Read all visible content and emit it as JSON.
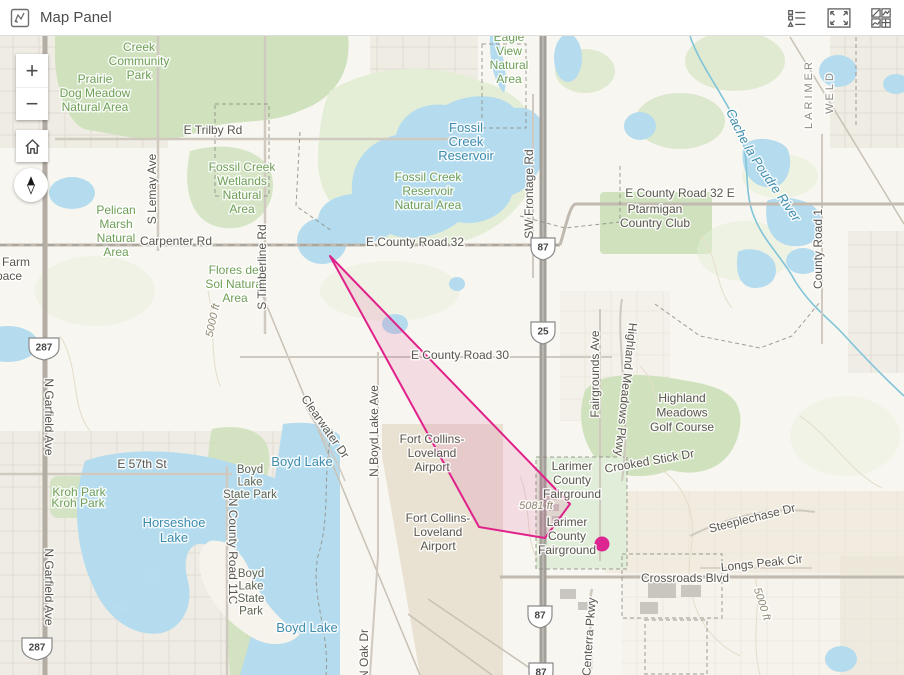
{
  "header": {
    "title": "Map Panel",
    "icons": [
      {
        "name": "map-panel-icon"
      },
      {
        "name": "legend-icon"
      },
      {
        "name": "expand-icon"
      },
      {
        "name": "basemap-gallery-icon"
      }
    ]
  },
  "controls": {
    "zoom_in_label": "+",
    "zoom_out_label": "−",
    "home": "home",
    "compass": "north"
  },
  "map": {
    "river_label": "Cache la Poudre River",
    "colors": {
      "highlight_pink": "#e0218a",
      "dot_magenta": "#dc2590",
      "water_blue": "#b5dcee",
      "park_green": "#cfe2bd",
      "label_green": "#6f9f58",
      "label_water": "#3f8cad",
      "label_road": "#5a564f",
      "highway_gray": "#a39f99"
    },
    "graphics": {
      "polygon": {
        "points": [
          [
            330,
            220
          ],
          [
            570,
            468
          ],
          [
            545,
            502
          ],
          [
            479,
            491
          ]
        ],
        "stroke": "#e0218a",
        "fill_opacity": 0.12
      },
      "dot": {
        "x": 602,
        "y": 508,
        "r": 7.5,
        "color": "#dc2590"
      }
    },
    "shields": [
      {
        "t": "87",
        "x": 543,
        "y": 211
      },
      {
        "t": "25",
        "x": 543,
        "y": 295
      },
      {
        "t": "87",
        "x": 540,
        "y": 579
      },
      {
        "t": "87",
        "x": 541,
        "y": 636
      },
      {
        "t": "287",
        "x": 44,
        "y": 311,
        "w": 15
      },
      {
        "t": "287",
        "x": 37,
        "y": 611,
        "w": 15
      }
    ],
    "labels": [
      {
        "lines": [
          "Creek",
          "Community",
          "Park"
        ],
        "x": 139,
        "y": 15,
        "cls": "park"
      },
      {
        "lines": [
          "Prairie",
          "Dog Meadow",
          "Natural Area"
        ],
        "x": 95,
        "y": 47,
        "cls": "park"
      },
      {
        "t": "E Trilby Rd",
        "x": 213,
        "y": 98,
        "cls": "road"
      },
      {
        "lines": [
          "Fossil Creek",
          "Wetlands",
          "Natural",
          "Area"
        ],
        "x": 242,
        "y": 135,
        "cls": "park"
      },
      {
        "lines": [
          "Fossil Creek",
          "Reservoir",
          "Natural Area"
        ],
        "x": 428,
        "y": 145,
        "cls": "park"
      },
      {
        "lines": [
          "Eagle",
          "View",
          "Natural",
          "Area"
        ],
        "x": 509,
        "y": 5,
        "cls": "park"
      },
      {
        "lines": [
          "Pelican",
          "Marsh",
          "Natural",
          "Area"
        ],
        "x": 116,
        "y": 178,
        "cls": "park"
      },
      {
        "lines": [
          "Flores del",
          "Sol Natural",
          "Area"
        ],
        "x": 235,
        "y": 238,
        "cls": "park"
      },
      {
        "t": "Kroh Park",
        "x": 79,
        "y": 460,
        "cls": "park"
      },
      {
        "t": "Kroh Park",
        "x": 78,
        "y": 471,
        "cls": "park",
        "color": "#55863f"
      },
      {
        "lines": [
          "Fossil",
          "Creek",
          "Reservoir"
        ],
        "x": 466,
        "y": 96,
        "cls": "water"
      },
      {
        "lines": [
          "Horseshoe",
          "Lake"
        ],
        "x": 174,
        "y": 491,
        "cls": "water",
        "lh": 15
      },
      {
        "t": "Boyd Lake",
        "x": 302,
        "y": 430,
        "cls": "water"
      },
      {
        "t": "Boyd Lake",
        "x": 307,
        "y": 596,
        "cls": "water"
      },
      {
        "t": "Carpenter Rd",
        "x": 176,
        "y": 209,
        "cls": "road"
      },
      {
        "t": "E County Road 32",
        "x": 415,
        "y": 210,
        "cls": "road"
      },
      {
        "t": "E County Road 32 E",
        "x": 680,
        "y": 161,
        "cls": "road"
      },
      {
        "t": "E County Road 30",
        "x": 460,
        "y": 323,
        "cls": "road"
      },
      {
        "t": "E 57th St",
        "x": 142,
        "y": 432,
        "cls": "road"
      },
      {
        "t": "Crossroads Blvd",
        "x": 685,
        "y": 546,
        "cls": "road"
      },
      {
        "t": "Longs Peak Cir",
        "x": 762,
        "y": 531,
        "cls": "road",
        "rot": -6
      },
      {
        "t": "Steeplechase Dr",
        "x": 753,
        "y": 486,
        "cls": "road",
        "rot": -14
      },
      {
        "t": "Crooked Stick Dr",
        "x": 650,
        "y": 429,
        "cls": "road",
        "rot": -10
      },
      {
        "t": "Clearwater Dr",
        "x": 322,
        "y": 393,
        "cls": "road",
        "rot": 55,
        "size": 11
      },
      {
        "t": "SW Frontage Rd",
        "x": 533,
        "y": 158,
        "cls": "road",
        "rot": -90
      },
      {
        "t": "S Lemay Ave",
        "x": 156,
        "y": 153,
        "cls": "road",
        "rot": -90
      },
      {
        "t": "S Timberline Rd",
        "x": 266,
        "y": 231,
        "cls": "road",
        "rot": -90
      },
      {
        "t": "Fairgrounds Ave",
        "x": 599,
        "y": 338,
        "cls": "road",
        "rot": -90
      },
      {
        "t": "Highland Meadows Pkwy",
        "x": 622,
        "y": 353,
        "cls": "road",
        "rot": 96
      },
      {
        "t": "County Road 1",
        "x": 822,
        "y": 213,
        "cls": "road",
        "rot": -90
      },
      {
        "t": "N County Road 11C",
        "x": 229,
        "y": 515,
        "cls": "road",
        "rot": 90
      },
      {
        "t": "N Garfield Ave",
        "x": 45,
        "y": 381,
        "cls": "road",
        "rot": 90
      },
      {
        "t": "N Garfield Ave",
        "x": 45,
        "y": 551,
        "cls": "road",
        "rot": 90
      },
      {
        "t": "N Boyd Lake Ave",
        "x": 378,
        "y": 395,
        "cls": "road",
        "rot": -90
      },
      {
        "t": "Centerra Pkwy",
        "x": 593,
        "y": 601,
        "cls": "road",
        "rot": -86
      },
      {
        "t": "N Oak Dr",
        "x": 368,
        "y": 618,
        "cls": "road",
        "rot": -90
      },
      {
        "lines": [
          "Ptarmigan",
          "Country Club"
        ],
        "x": 655,
        "y": 177,
        "cls": "road"
      },
      {
        "lines": [
          "Highland",
          "Meadows",
          "Golf Course"
        ],
        "x": 682,
        "y": 366,
        "cls": "road",
        "lh": 14.5
      },
      {
        "lines": [
          "Larimer",
          "County",
          "Fairground"
        ],
        "x": 572,
        "y": 434,
        "cls": "road"
      },
      {
        "lines": [
          "Larimer",
          "County",
          "Fairground"
        ],
        "x": 567,
        "y": 490,
        "cls": "road"
      },
      {
        "lines": [
          "Fort Collins-",
          "Loveland",
          "Airport"
        ],
        "x": 432,
        "y": 407,
        "cls": "road"
      },
      {
        "lines": [
          "Fort Collins-",
          "Loveland",
          "Airport"
        ],
        "x": 438,
        "y": 486,
        "cls": "road"
      },
      {
        "lines": [
          "Boyd",
          "Lake",
          "State Park"
        ],
        "x": 250,
        "y": 437,
        "cls": "dark",
        "lh": 12.5
      },
      {
        "lines": [
          "Boyd",
          "Lake",
          "State",
          "Park"
        ],
        "x": 251,
        "y": 541,
        "cls": "dark",
        "lh": 12.5
      },
      {
        "t": "LARIMER",
        "x": 812,
        "y": 58,
        "cls": "county",
        "rot": -90
      },
      {
        "t": "WELD",
        "x": 833,
        "y": 56,
        "cls": "county",
        "rot": -90
      },
      {
        "t": "5000 ft",
        "x": 216,
        "y": 285,
        "cls": "elev",
        "rot": -78
      },
      {
        "t": "5081 ft",
        "x": 536,
        "y": 473,
        "cls": "elev",
        "size": 12
      },
      {
        "t": "5000 ft",
        "x": 759,
        "y": 569,
        "cls": "elev",
        "rot": 72
      },
      {
        "t": "New Farm",
        "x": 30,
        "y": 230,
        "cls": "road",
        "anchor": "end"
      },
      {
        "t": "Space",
        "x": 22,
        "y": 244,
        "cls": "road",
        "anchor": "end"
      }
    ]
  }
}
